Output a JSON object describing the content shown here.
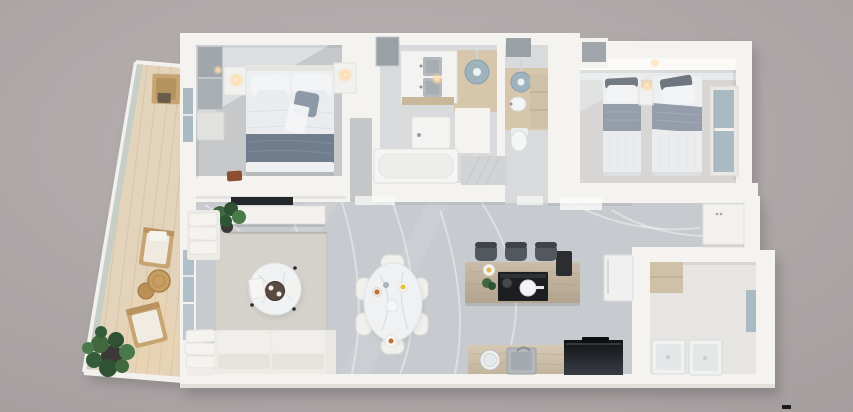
{
  "scene": {
    "kind": "top-down 3D architectural render of an apartment floor plan",
    "canvas": {
      "width": 853,
      "height": 412
    },
    "no_visible_text": true
  },
  "palette": {
    "bg_inner": "#b9b2b3",
    "bg_outer": "#a49d9e",
    "shadow": "#4a4547",
    "wall": "#f4f3f0",
    "wall_shade": "#dedbd7",
    "marble": "#c7cbcf",
    "marble_vein": "#eef0f2",
    "carpet": "#c7c8ca",
    "bed2_floor": "#d8d6d4",
    "bath_floor": "#d9dadb",
    "wood_floor": "#d5c6ac",
    "corridor": "#c5c6c8",
    "deck": "#e3d3ba",
    "deck_line": "#cfbd9f",
    "glass": "#a9bac3",
    "glass_rail": "#c3cec8",
    "rug": "#d5d2cb",
    "sofa": "#edebe6",
    "white_furn": "#f1f1ef",
    "gray_panel": "#a0a6ab",
    "wood_furn": "#c7a572",
    "wood_cab": "#cfc0a8",
    "stool": "#53585f",
    "dark_appl": "#1c1e21",
    "blanket": "#949da9",
    "blanket_dark": "#6f7d8c",
    "duvet": "#eaecee",
    "pillow": "#f3f4f6",
    "pillow_dark": "#747b84",
    "plant_a": "#41683f",
    "plant_b": "#2e5233",
    "plant_c": "#4a7a4a",
    "pot": "#3c3835",
    "lamp": "#ffd9a2",
    "tray_brown": "#5b4a42",
    "accent_yellow": "#e3c23c",
    "accent_orange": "#bf7034",
    "shower_head": "#9fb3bd",
    "steel": "#b4b8bc",
    "watermark": "#1a1a1a"
  },
  "apartment": {
    "rooms": [
      {
        "id": "master-bedroom",
        "furniture": [
          "double-bed",
          "wardrobe",
          "dresser",
          "nightstand-left",
          "nightstand-right",
          "wall-lamps",
          "bench"
        ]
      },
      {
        "id": "bathroom-1",
        "furniture": [
          "mirror-cabinet",
          "vanity-two-sinks",
          "pendant-light",
          "rain-shower",
          "shower-tray",
          "bathtub"
        ]
      },
      {
        "id": "bathroom-2",
        "furniture": [
          "mirror-cabinet",
          "rain-shower",
          "wall-sink",
          "toilet",
          "wood-cabinet"
        ]
      },
      {
        "id": "twin-bedroom",
        "furniture": [
          "twin-bed-left",
          "twin-bed-right",
          "nightstand",
          "wall-lamp",
          "closet",
          "window"
        ]
      },
      {
        "id": "living-dining-kitchen",
        "furniture": [
          "tv",
          "media-console",
          "plant",
          "chaise",
          "sofa",
          "pillow-stack",
          "rug",
          "coffee-table",
          "dining-table",
          "dining-chairs-x6",
          "kitchen-island",
          "bar-stools-x3",
          "cooktop",
          "counter-sink",
          "round-basin",
          "oven",
          "fridge",
          "coffee-machine",
          "entry-cabinet"
        ]
      },
      {
        "id": "laundry-room",
        "furniture": [
          "upper-cabinet",
          "washer",
          "dryer",
          "window"
        ]
      },
      {
        "id": "balcony",
        "furniture": [
          "glass-railing",
          "bench",
          "lounge-chair-top",
          "side-tables",
          "lounge-chair-bottom",
          "potted-plant"
        ]
      }
    ]
  },
  "watermark": {
    "present": true,
    "color": "#1a1a1a"
  }
}
